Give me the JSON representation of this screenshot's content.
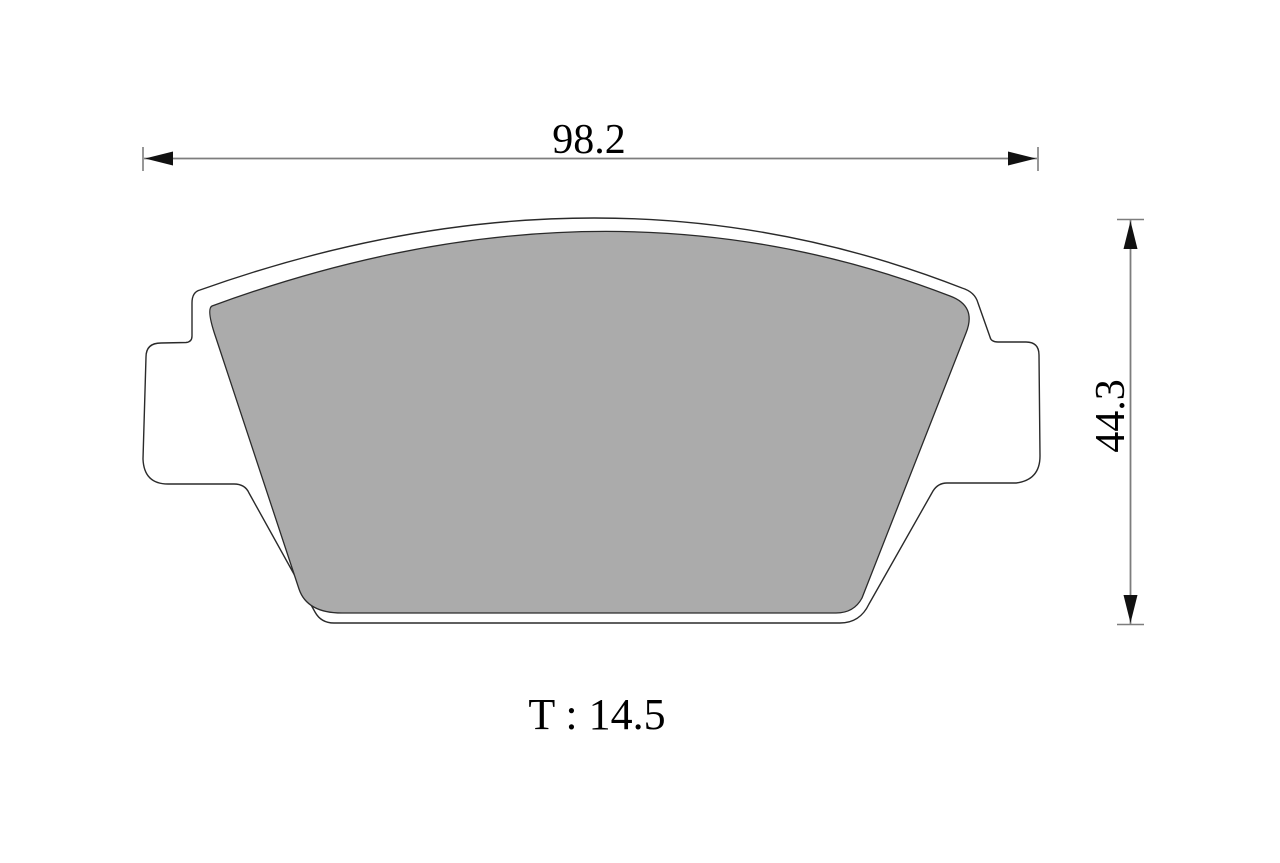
{
  "drawing": {
    "labels": {
      "width_dim": "98.2",
      "height_dim": "44.3",
      "thickness": "T : 14.5"
    },
    "colors": {
      "background": "#ffffff",
      "backplate_fill": "#ffffff",
      "friction_fill": "#ababab",
      "outline": "#2a2a2a",
      "dimension_line": "#7d7d7d",
      "arrowhead": "#111111",
      "text": "#000000"
    }
  }
}
